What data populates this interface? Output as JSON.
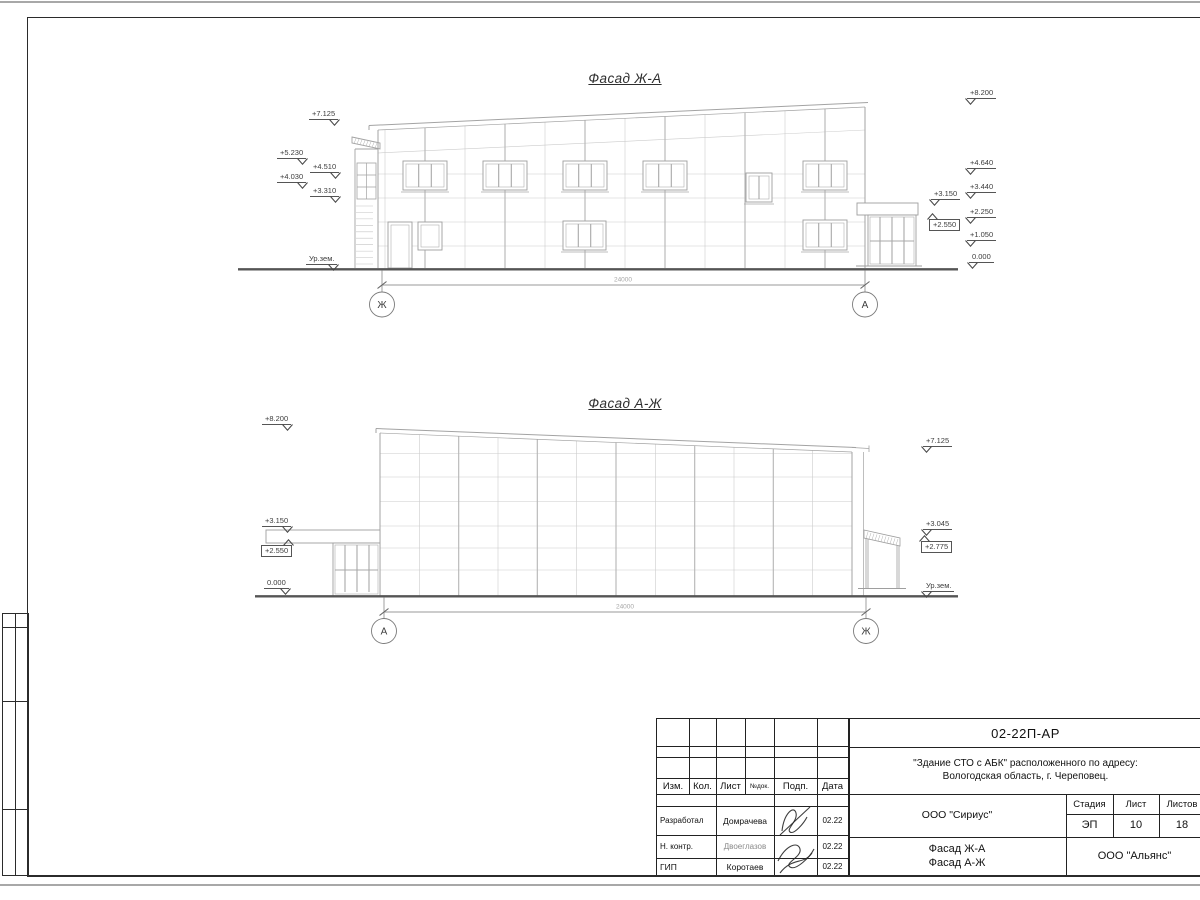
{
  "facades": {
    "f1": {
      "title": "Фасад Ж-А",
      "dimension": "24000",
      "axis_left": "Ж",
      "axis_right": "А",
      "marks": {
        "left": [
          "+7.125",
          "+5.230",
          "+4.510",
          "+4.030",
          "+3.310",
          "Ур.зем."
        ],
        "right": [
          "+8.200",
          "+4.640",
          "+3.440",
          "+2.250",
          "+1.050",
          "0.000"
        ],
        "near": [
          "+3.150",
          "+2.550"
        ]
      }
    },
    "f2": {
      "title": "Фасад А-Ж",
      "dimension": "24000",
      "axis_left": "А",
      "axis_right": "Ж",
      "marks": {
        "left": [
          "+8.200",
          "+3.150",
          "+2.550",
          "0.000"
        ],
        "right": [
          "+7.125",
          "+3.045",
          "+2.775",
          "Ур.зем."
        ]
      }
    }
  },
  "titleblock": {
    "doc_code": "02-22П-АР",
    "project_line1": "\"Здание СТО с АБК\" расположенного по адресу:",
    "project_line2": "Вологодская область, г. Череповец.",
    "designer_org": "ООО \"Сириус\"",
    "client_org": "ООО \"Альянс\"",
    "content_line1": "Фасад Ж-А",
    "content_line2": "Фасад А-Ж",
    "columns": {
      "izm": "Изм.",
      "kol": "Кол.",
      "list": "Лист",
      "ndok": "№док.",
      "podp": "Подп.",
      "data": "Дата",
      "stadia": "Стадия",
      "sheet": "Лист",
      "sheets": "Листов"
    },
    "stadia_value": "ЭП",
    "sheet_value": "10",
    "sheets_value": "18",
    "rows": [
      {
        "role": "Разработал",
        "name": "Домрачева",
        "date": "02.22"
      },
      {
        "role": "Н. контр.",
        "name": "Двоеглазов",
        "date": "02.22"
      },
      {
        "role": "ГИП",
        "name": "Коротаев",
        "date": "02.22"
      }
    ]
  }
}
